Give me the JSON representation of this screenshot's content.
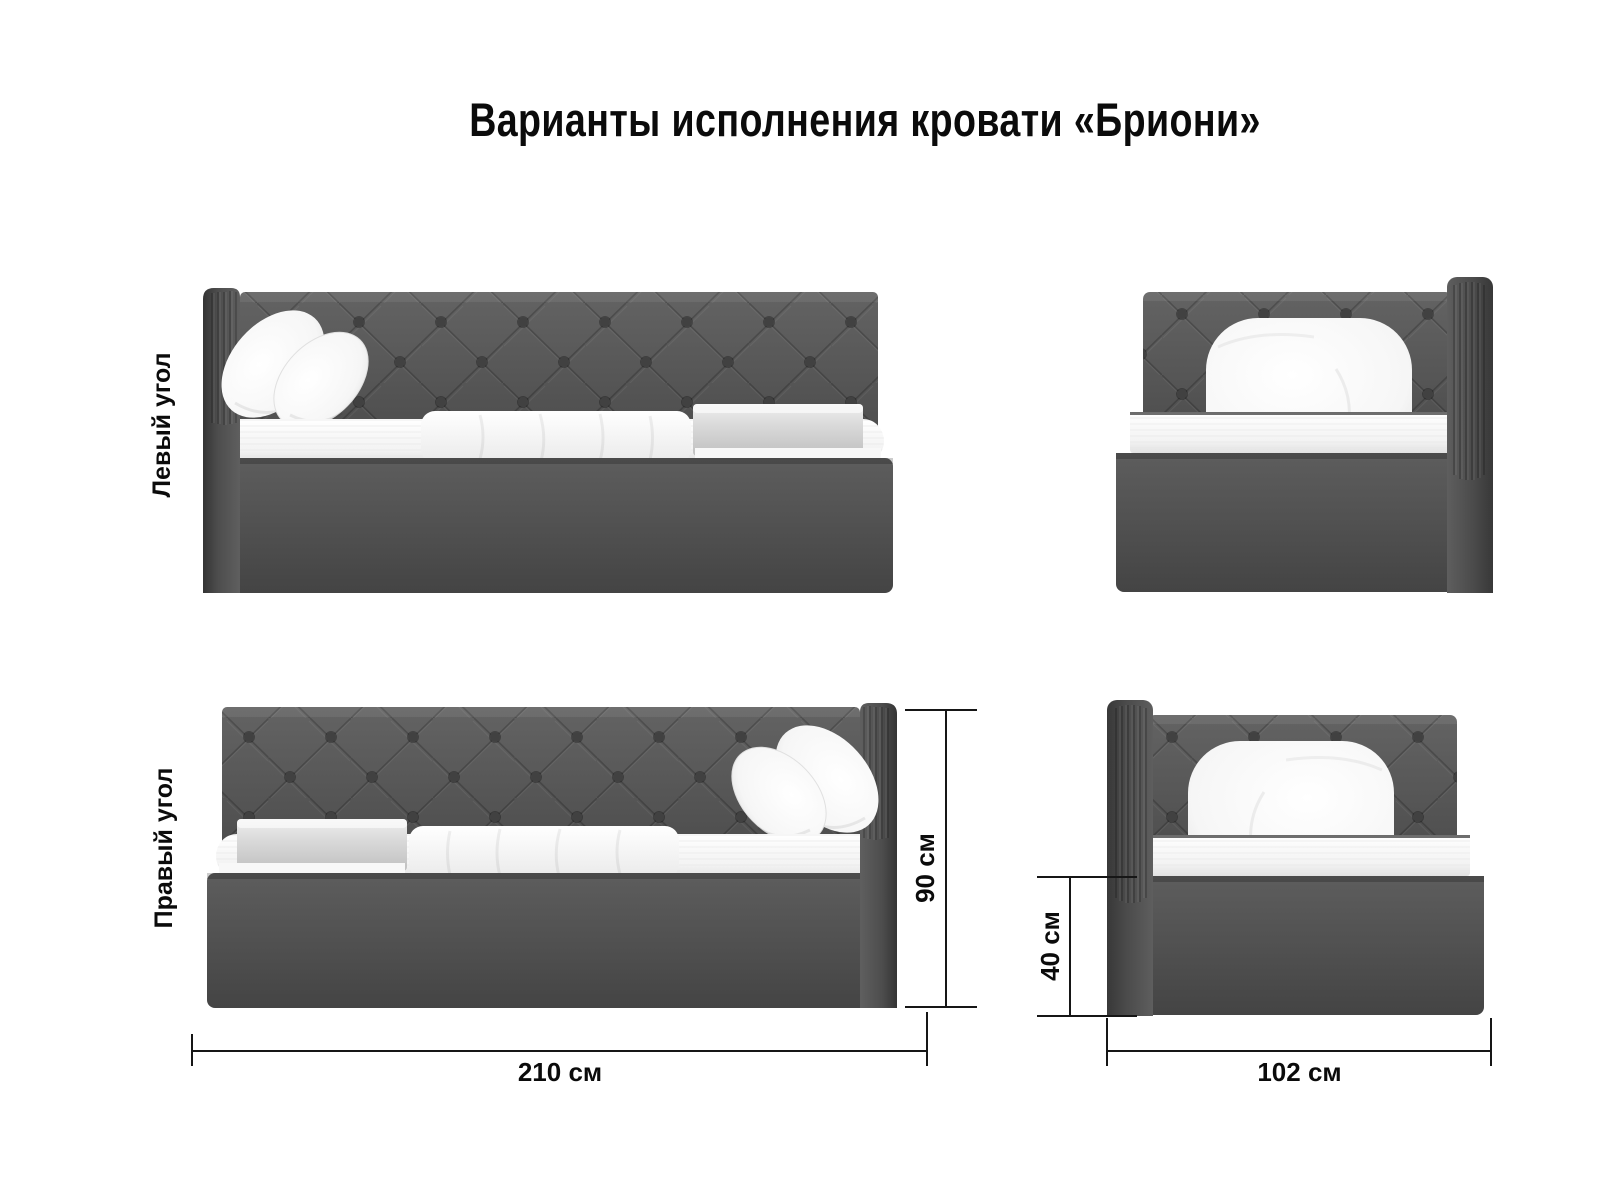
{
  "page": {
    "title": "Варианты исполнения кровати «Бриони»"
  },
  "variants": [
    {
      "id": "left-corner",
      "label": "Левый угол"
    },
    {
      "id": "right-corner",
      "label": "Правый угол"
    }
  ],
  "views": [
    {
      "id": "left-corner-side",
      "description": "bed-side-view-wing-left"
    },
    {
      "id": "left-corner-front",
      "description": "bed-front-view-wing-right"
    },
    {
      "id": "right-corner-side",
      "description": "bed-side-view-wing-right"
    },
    {
      "id": "right-corner-front",
      "description": "bed-front-view-wing-left"
    }
  ],
  "dimensions": {
    "length": {
      "label": "210 см"
    },
    "height": {
      "label": "90 см"
    },
    "base_height": {
      "label": "40 см"
    },
    "width": {
      "label": "102 см"
    }
  },
  "colors": {
    "background": "#ffffff",
    "text": "#0b0b0b",
    "line": "#161616",
    "fabric": "#515151",
    "fabric_dark": "#3a3a3a",
    "fabric_light": "#616161",
    "button": "#404040",
    "mattress": "#f4f4f4",
    "pillow": "#fdfdfd",
    "blanket": "#cccccc"
  }
}
